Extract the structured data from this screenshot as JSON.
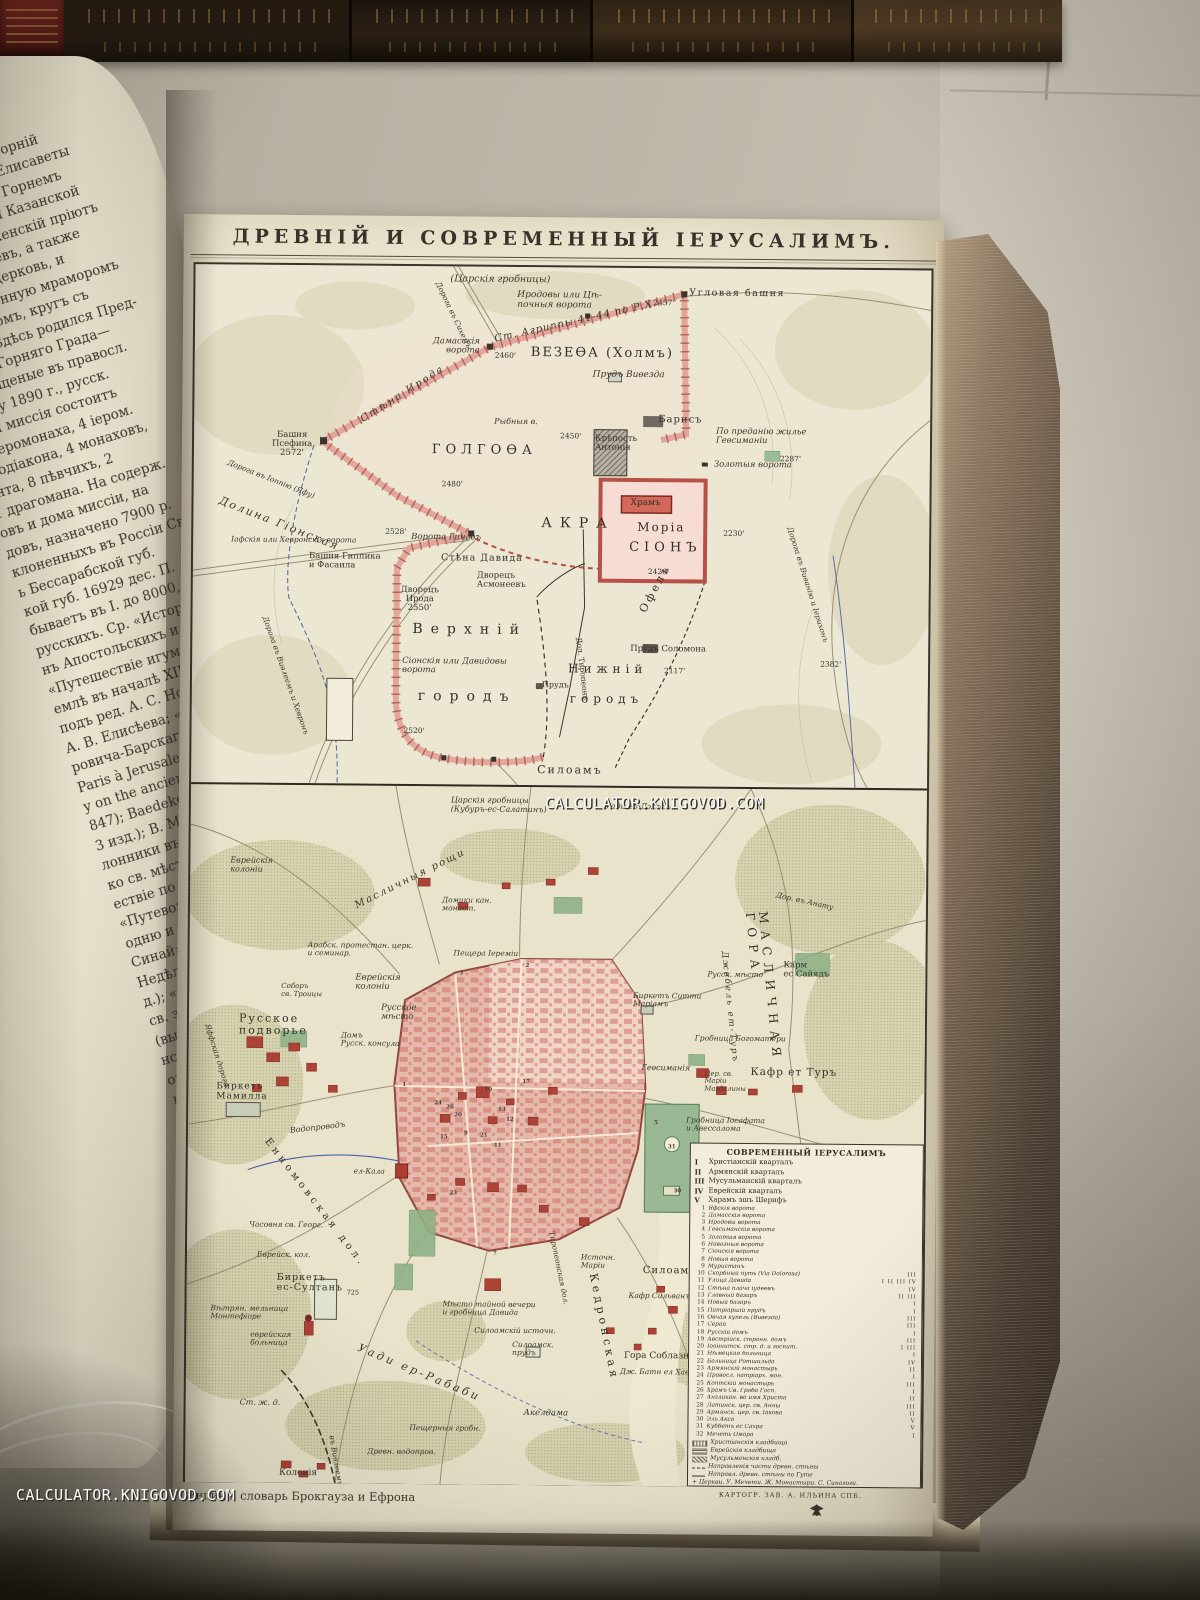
{
  "watermark": {
    "text": "CALCULATOR.KNIGOVOD.COM"
  },
  "page": {
    "title": "ДРЕВНІЙ И СОВРЕМЕННЫЙ ІЕРУСАЛИМЪ.",
    "caption_left": "Энцикл. словарь Брокгауза и Ефрона",
    "caption_right": "КАРТОГР. ЗАВ. А. ИЛЬИНА СПБ."
  },
  "left_page": {
    "lines": [
      "Горняя» или «Горній",
      "али Захарія и Елисаветы",
      "Предтечи. Въ Горнемъ",
      "храмъ во имя Казанской",
      "астырскій женскій пріютъ",
      "богомольцевъ, а также",
      "астырь и церковь, и",
      "ъ выложенную мраморомъ",
      "престоломъ, кругъ съ",
      "ъ яз.: «Здѣсь родился Пред-",
      "ители Горняго Града—",
      "ю крещеные въ правосл.",
      "штату 1890 г., русск.",
      "зная миссія состоитъ",
      "п. іеромонаха, 4 іером.",
      "еродіакона, 4 монаховъ,",
      "ента, 8 пѣвчихъ, 2",
      "1 драгомана. На содерж.",
      "овъ и дома миссіи, на",
      "довъ, назначено 7900 р.",
      "клоненныхъ въ Россіи Св.",
      "ь Бессарабской губ.",
      "кой губ. 16929 дес. П.",
      "бываетъ въ І. до 8000, изъ",
      "русскихъ. Ср. «Исторія",
      "нъ Апостольскихъ и до",
      "«Путешествіе игумена",
      "емлѣ въ началѣ XII в.»",
      "подъ ред. А. С. Норова;",
      "А. В. Елисѣева; «Стран-",
      "ровича-Барскаго; Chateau-",
      "Paris à Jerusalem» (1811);",
      "y on the ancient topo-",
      "847); Baedeker, «Palesti-",
      "3 изд.); В. Мансуровъ,",
      "лонники въ Палестинѣ»",
      "ко св. мѣстамъ въ 18",
      "ествіе по св. землѣ въ",
      "«Путеводитель въ св.",
      "одню и прочимъ св.",
      "Синай», паломника-свя-",
      "Недѣля въ Палестинѣ»,",
      "д.); «Спутникъ правосл.",
      "св. землю», протоіерея",
      "(вып. 2-й); «Воспомина-",
      "нстантинополь, Каиръ и",
      "оптева; «Путешествіе",
      "ину», Е. Картавцевъ",
      "омъ мѣстѣ близъ храм.",
      ", архим. Антонина",
      "земля и Библія» (вып.",
      "св. землѣ», В. Н. Хитр.",
      "четы Имп. правосл. пал.",
      "94). О патріаршей библ.",
      "Керамевсъ.",
      "внѣйшія дошедшія до",
      "аключаются въ письм.",
      "ыхъ въ Эль-Амарнѣ, въ",
      "одержащихъ въ себѣ, м.",
      "царя Урсалимму въ",
      "ІІІ (XIV—XV в. до Р. Х.",
      "ѣсь какъ резиденція",
      "властью Египта. Въ Б.",
      "нается, подъ именемъ",
      "тія (XIV, 18), салимск.",
      "царемъ салимскимъ",
      "встрѣчается въ кн.",
      "по главѣ царей хана.",
      "противъ Іисуса Навина"
    ]
  },
  "upper_map": {
    "labels": [
      {
        "t": "(Царскія гробницы)",
        "x": 255,
        "y": 8,
        "s": 9.5,
        "it": 1
      },
      {
        "t": "Иродовы или Цѣ-\nпочныя ворота",
        "x": 322,
        "y": 24,
        "s": 9,
        "it": 1
      },
      {
        "t": "Угловая башня",
        "x": 494,
        "y": 20,
        "s": 9.5,
        "sp": 1.5
      },
      {
        "t": "2457'",
        "x": 458,
        "y": 31,
        "s": 7.5
      },
      {
        "t": "Ст. Агриппы 41-44 по Р.Х.",
        "x": 300,
        "y": 68,
        "s": 10,
        "it": 1,
        "rot": -13,
        "sp": 1
      },
      {
        "t": "ВЕЗЕѲА (Холмъ)",
        "x": 336,
        "y": 79,
        "s": 13,
        "sp": 2
      },
      {
        "t": "Прудъ Виѳезда",
        "x": 398,
        "y": 103,
        "s": 9,
        "it": 1
      },
      {
        "t": "Дамасскія\nворота",
        "x": 238,
        "y": 71,
        "s": 8.5,
        "it": 1,
        "ta": "right"
      },
      {
        "t": "2460'",
        "x": 300,
        "y": 85,
        "s": 7.5
      },
      {
        "t": "Дорога въ Сихемъ",
        "x": 242,
        "y": 12,
        "s": 7.5,
        "it": 1,
        "rot": 64
      },
      {
        "t": "Башня\nПсефина\n2572'",
        "x": 78,
        "y": 166,
        "s": 8.5,
        "ta": "center"
      },
      {
        "t": "Стѣна Ирода",
        "x": 168,
        "y": 150,
        "s": 10,
        "it": 1,
        "rot": -33,
        "sp": 2
      },
      {
        "t": "ГОЛГОѲА",
        "x": 238,
        "y": 177,
        "s": 13,
        "sp": 5
      },
      {
        "t": "2480'",
        "x": 248,
        "y": 214,
        "s": 7.5
      },
      {
        "t": "Рыбныя в.",
        "x": 300,
        "y": 151,
        "s": 8,
        "it": 1
      },
      {
        "t": "2450'",
        "x": 366,
        "y": 165,
        "s": 7.5
      },
      {
        "t": "Крѣпость\nАнтонія",
        "x": 401,
        "y": 167,
        "s": 8.5
      },
      {
        "t": "Барисъ",
        "x": 464,
        "y": 147,
        "s": 10,
        "sp": 1
      },
      {
        "t": "По преданію жилье\nГеѳсиманіи",
        "x": 522,
        "y": 159,
        "s": 8.5,
        "it": 1
      },
      {
        "t": "2287'",
        "x": 586,
        "y": 186,
        "s": 7.5
      },
      {
        "t": "Золотыя ворота",
        "x": 520,
        "y": 192,
        "s": 8.5,
        "it": 1
      },
      {
        "t": "Храмъ",
        "x": 437,
        "y": 231,
        "s": 9
      },
      {
        "t": "Моріа",
        "x": 444,
        "y": 253,
        "s": 12,
        "sp": 2
      },
      {
        "t": "СІОНЪ",
        "x": 436,
        "y": 273,
        "s": 13,
        "sp": 5
      },
      {
        "t": "2420'",
        "x": 455,
        "y": 300,
        "s": 7.5
      },
      {
        "t": "АКРА",
        "x": 348,
        "y": 249,
        "s": 14,
        "sp": 8
      },
      {
        "t": "2230'",
        "x": 530,
        "y": 261,
        "s": 7.5
      },
      {
        "t": "Дорога въ Виѳанію и Іерихонъ",
        "x": 596,
        "y": 254,
        "s": 7.5,
        "it": 1,
        "rot": 72
      },
      {
        "t": "Дорога въ Іоппію (Яфу)",
        "x": 34,
        "y": 194,
        "s": 7.5,
        "it": 1,
        "rot": 21
      },
      {
        "t": "Долина Гіонская",
        "x": 26,
        "y": 230,
        "s": 11,
        "it": 1,
        "rot": 21,
        "sp": 2
      },
      {
        "t": "Іафскія или Хевронскія ворота",
        "x": 38,
        "y": 271,
        "s": 7.5,
        "it": 1
      },
      {
        "t": "2528'",
        "x": 192,
        "y": 262,
        "s": 7.5
      },
      {
        "t": "Ворота Гинаѳъ",
        "x": 218,
        "y": 267,
        "s": 8.5,
        "it": 1
      },
      {
        "t": "Башня Гиппика\nи Фасаила",
        "x": 116,
        "y": 287,
        "s": 8.5
      },
      {
        "t": "Стѣна Давида",
        "x": 248,
        "y": 287,
        "s": 9.5,
        "sp": 1
      },
      {
        "t": "Дворецъ\nИрода\n2550'",
        "x": 208,
        "y": 320,
        "s": 8.5,
        "ta": "center"
      },
      {
        "t": "Дворецъ\nАсмонеевъ",
        "x": 284,
        "y": 305,
        "s": 8.5
      },
      {
        "t": "Верхній",
        "x": 220,
        "y": 356,
        "s": 14,
        "sp": 8
      },
      {
        "t": "Сіонскія или Давидовы\nворота",
        "x": 210,
        "y": 391,
        "s": 8.5,
        "it": 1
      },
      {
        "t": "городъ",
        "x": 226,
        "y": 423,
        "s": 14,
        "sp": 8
      },
      {
        "t": "2520'",
        "x": 212,
        "y": 461,
        "s": 7.5
      },
      {
        "t": "Нижній",
        "x": 376,
        "y": 395,
        "s": 12,
        "sp": 5
      },
      {
        "t": "городъ",
        "x": 378,
        "y": 425,
        "s": 12,
        "sp": 5
      },
      {
        "t": "Прудъ",
        "x": 350,
        "y": 414,
        "s": 8
      },
      {
        "t": "Прудъ Соломона",
        "x": 438,
        "y": 377,
        "s": 8.5
      },
      {
        "t": "2117'",
        "x": 472,
        "y": 399,
        "s": 7.5
      },
      {
        "t": "Дол. Тиропеонъ",
        "x": 386,
        "y": 366,
        "s": 7.5,
        "rot": 83
      },
      {
        "t": "Офелъ",
        "x": 450,
        "y": 338,
        "s": 11,
        "sp": 3,
        "rot": -62
      },
      {
        "t": "Дорога въ Виѳлеемъ и Хевронъ",
        "x": 72,
        "y": 348,
        "s": 7.5,
        "it": 1,
        "rot": 70
      },
      {
        "t": "2382'",
        "x": 628,
        "y": 391,
        "s": 7.5
      },
      {
        "t": "Силоамъ",
        "x": 346,
        "y": 497,
        "s": 11,
        "sp": 2
      }
    ]
  },
  "lower_map": {
    "labels": [
      {
        "t": "Царскія гробницы\n(Кубуръ-ес-Салатинъ)",
        "x": 260,
        "y": 10,
        "s": 8,
        "it": 1
      },
      {
        "t": "Уади ед-Джосъ",
        "x": 414,
        "y": 15,
        "s": 8,
        "it": 1
      },
      {
        "t": "Масличныя рощи",
        "x": 166,
        "y": 116,
        "s": 10,
        "it": 1,
        "rot": -27,
        "sp": 2
      },
      {
        "t": "Еврейскія\nколоніи",
        "x": 40,
        "y": 72,
        "s": 8,
        "it": 1
      },
      {
        "t": "Домики кан.\nмонаст.",
        "x": 252,
        "y": 110,
        "s": 7.5,
        "it": 1
      },
      {
        "t": "Арабск. протестан. церк.\nи семинар.",
        "x": 118,
        "y": 156,
        "s": 7.5,
        "it": 1
      },
      {
        "t": "Пещера Іереміи",
        "x": 264,
        "y": 163,
        "s": 7.5,
        "it": 1
      },
      {
        "t": "Еврейскія\nколоніи",
        "x": 166,
        "y": 188,
        "s": 8.5,
        "it": 1
      },
      {
        "t": "Русское\nмѣсто",
        "x": 192,
        "y": 218,
        "s": 8.5,
        "it": 1
      },
      {
        "t": "Русское\nподворье",
        "x": 50,
        "y": 228,
        "s": 11,
        "sp": 2
      },
      {
        "t": "Соборъ\nсв. Троицы",
        "x": 92,
        "y": 198,
        "s": 7,
        "it": 1
      },
      {
        "t": "Домъ\nРусск. консула",
        "x": 152,
        "y": 246,
        "s": 7.5,
        "it": 1
      },
      {
        "t": "Яффская дорога",
        "x": 18,
        "y": 236,
        "s": 7.5,
        "it": 1,
        "rot": 72
      },
      {
        "t": "Биркетъ Ситти\nМаріамъ",
        "x": 444,
        "y": 204,
        "s": 7.5,
        "it": 1
      },
      {
        "t": "Геѳсиманія",
        "x": 453,
        "y": 276,
        "s": 8,
        "it": 1
      },
      {
        "t": "Гробница Богоматери",
        "x": 506,
        "y": 246,
        "s": 7.5,
        "it": 1
      },
      {
        "t": "Русск. мѣсто",
        "x": 518,
        "y": 182,
        "s": 7.5,
        "it": 1
      },
      {
        "t": "Карм\nес Сайядъ",
        "x": 594,
        "y": 172,
        "s": 8.5
      },
      {
        "t": "МАСЛИЧНАЯ ГОРА",
        "x": 566,
        "y": 110,
        "s": 12,
        "sp": 7,
        "rot": 84
      },
      {
        "t": "Джебель ет-Туръ",
        "x": 534,
        "y": 158,
        "s": 8.5,
        "it": 1,
        "rot": 84,
        "sp": 2
      },
      {
        "t": "Кафр ет Туръ",
        "x": 562,
        "y": 278,
        "s": 10.5,
        "sp": 1
      },
      {
        "t": "Цер. св.\nМаріи\nМагдалины",
        "x": 516,
        "y": 282,
        "s": 6.8,
        "it": 1
      },
      {
        "t": "Дор. въ Анату",
        "x": 586,
        "y": 102,
        "s": 7.5,
        "it": 1,
        "rot": 12
      },
      {
        "t": "Биркетъ\nМамилла",
        "x": 28,
        "y": 298,
        "s": 9,
        "sp": 1
      },
      {
        "t": "Водопроводъ",
        "x": 102,
        "y": 342,
        "s": 8,
        "it": 1,
        "rot": -7
      },
      {
        "t": "Енномовская дол.",
        "x": 78,
        "y": 350,
        "s": 10,
        "sp": 4,
        "rot": 52
      },
      {
        "t": "ел-Кала",
        "x": 166,
        "y": 382,
        "s": 7.5,
        "it": 1
      },
      {
        "t": "Часовня св. Георг.",
        "x": 62,
        "y": 436,
        "s": 7.5,
        "it": 1
      },
      {
        "t": "Еврейск. кол.",
        "x": 70,
        "y": 466,
        "s": 7.5,
        "it": 1
      },
      {
        "t": "Биркетъ\nес-Султанъ",
        "x": 90,
        "y": 488,
        "s": 9.5,
        "sp": 1
      },
      {
        "t": "725",
        "x": 160,
        "y": 504,
        "s": 6.5
      },
      {
        "t": "Вѣтрян. мельница\nМонтефіоре",
        "x": 24,
        "y": 520,
        "s": 7.5,
        "it": 1
      },
      {
        "t": "еврейская\nбольница",
        "x": 64,
        "y": 546,
        "s": 7.5,
        "it": 1
      },
      {
        "t": "Ст. ж. д.",
        "x": 54,
        "y": 614,
        "s": 8,
        "it": 1
      },
      {
        "t": "Колонія",
        "x": 94,
        "y": 684,
        "s": 9
      },
      {
        "t": "Уади ер-Рабаби",
        "x": 172,
        "y": 556,
        "s": 11,
        "it": 1,
        "sp": 3,
        "rot": 22
      },
      {
        "t": "Пещерныя гробн.",
        "x": 224,
        "y": 638,
        "s": 7.5,
        "it": 1
      },
      {
        "t": "Акелдама",
        "x": 338,
        "y": 622,
        "s": 8.5,
        "it": 1
      },
      {
        "t": "Древн. водопров.",
        "x": 182,
        "y": 662,
        "s": 7.5,
        "it": 1
      },
      {
        "t": "Мѣсто тайной вечери\nи гробница Давида",
        "x": 256,
        "y": 514,
        "s": 7.5,
        "it": 1
      },
      {
        "t": "Силоамскій источн.",
        "x": 288,
        "y": 540,
        "s": 7.5,
        "it": 1
      },
      {
        "t": "Силоамск.\nпрудъ",
        "x": 326,
        "y": 554,
        "s": 7.5,
        "it": 1
      },
      {
        "t": "Тиропеонская дол.",
        "x": 364,
        "y": 440,
        "s": 7.5,
        "it": 1,
        "rot": 78
      },
      {
        "t": "Источн.\nМаріи",
        "x": 394,
        "y": 466,
        "s": 7.5,
        "it": 1
      },
      {
        "t": "Силоамъ",
        "x": 456,
        "y": 478,
        "s": 10,
        "sp": 1
      },
      {
        "t": "Кафр Сильванъ",
        "x": 442,
        "y": 504,
        "s": 7.5,
        "it": 1
      },
      {
        "t": "Гора Соблазна",
        "x": 438,
        "y": 564,
        "s": 9
      },
      {
        "t": "Дж. Батн ел Хава",
        "x": 434,
        "y": 580,
        "s": 7.5,
        "it": 1
      },
      {
        "t": "Кедронская",
        "x": 406,
        "y": 480,
        "s": 11,
        "sp": 4,
        "rot": 78
      },
      {
        "t": "въ Виѳлеемъ",
        "x": 146,
        "y": 646,
        "s": 7.5,
        "it": 1,
        "rot": 80
      },
      {
        "t": "Гробница Іосафата\nи Авессалома",
        "x": 498,
        "y": 328,
        "s": 7.5,
        "it": 1
      }
    ],
    "city_numbers": [
      {
        "n": "1",
        "x": 214,
        "y": 296
      },
      {
        "n": "2",
        "x": 336,
        "y": 176
      },
      {
        "n": "3",
        "x": 270,
        "y": 184
      },
      {
        "n": "5",
        "x": 466,
        "y": 332
      },
      {
        "n": "7",
        "x": 306,
        "y": 464
      },
      {
        "n": "9",
        "x": 276,
        "y": 344
      },
      {
        "n": "10",
        "x": 296,
        "y": 300
      },
      {
        "n": "11",
        "x": 306,
        "y": 356
      },
      {
        "n": "12",
        "x": 318,
        "y": 330
      },
      {
        "n": "13",
        "x": 310,
        "y": 320
      },
      {
        "n": "15",
        "x": 252,
        "y": 348
      },
      {
        "n": "17",
        "x": 334,
        "y": 292
      },
      {
        "n": "20",
        "x": 266,
        "y": 326
      },
      {
        "n": "21",
        "x": 292,
        "y": 346
      },
      {
        "n": "23",
        "x": 262,
        "y": 404
      },
      {
        "n": "24",
        "x": 246,
        "y": 314
      },
      {
        "n": "26",
        "x": 258,
        "y": 318
      },
      {
        "n": "30",
        "x": 486,
        "y": 400
      },
      {
        "n": "31",
        "x": 480,
        "y": 356
      }
    ],
    "legend": {
      "title": "СОВРЕМЕННЫЙ ІЕРУСАЛИМЪ",
      "quarters": [
        [
          "I",
          "Христіанскій кварталъ"
        ],
        [
          "II",
          "Армянскій кварталъ"
        ],
        [
          "III",
          "Мусульманскій кварталъ"
        ],
        [
          "IV",
          "Еврейскій кварталъ"
        ],
        [
          "V",
          "Харамъ эшъ Шерифъ"
        ]
      ],
      "items": [
        [
          "1",
          "Яфскія ворота",
          ""
        ],
        [
          "2",
          "Дамасскія ворота",
          ""
        ],
        [
          "3",
          "Иродовы ворота",
          ""
        ],
        [
          "4",
          "Геѳсиманскія ворота",
          ""
        ],
        [
          "5",
          "Золотыя ворота",
          ""
        ],
        [
          "6",
          "Навозныя ворота",
          ""
        ],
        [
          "7",
          "Сіонскія ворота",
          ""
        ],
        [
          "8",
          "Новыя ворота",
          ""
        ],
        [
          "9",
          "Муристанъ",
          ""
        ],
        [
          "10",
          "Скорбный путь (Via Dolorosa)",
          "III"
        ],
        [
          "11",
          "Улица Давида",
          "I II III IV"
        ],
        [
          "12",
          "Стѣна плача іудеевъ",
          "IV"
        ],
        [
          "13",
          "Главный базаръ",
          "II III"
        ],
        [
          "14",
          "Новый базаръ",
          "I"
        ],
        [
          "15",
          "Патріаршій прудъ",
          "I"
        ],
        [
          "16",
          "Овчая купель (Виѳезда)",
          "III"
        ],
        [
          "17",
          "Серай",
          "III"
        ],
        [
          "18",
          "Русскій домъ",
          "I"
        ],
        [
          "19",
          "Австрійск. странн. домъ",
          "III"
        ],
        [
          "20",
          "Іоаннитск. стр. д. и госпит.",
          "I III"
        ],
        [
          "21",
          "Нѣмецкая больница",
          "I"
        ],
        [
          "22",
          "Больница Ротшильда",
          "IV"
        ],
        [
          "23",
          "Армянскій монастырь",
          "II"
        ],
        [
          "24",
          "Правосл. патріарх. мон.",
          "I"
        ],
        [
          "25",
          "Коптскій монастырь",
          "III"
        ],
        [
          "26",
          "Храмъ Св. Гроба Госп.",
          "I"
        ],
        [
          "27",
          "Англикан. во имя Христа",
          "II"
        ],
        [
          "28",
          "Латинск. цер. св. Анны",
          "III"
        ],
        [
          "29",
          "Армянск. цер. св. Іакова",
          "II"
        ],
        [
          "30",
          "Эль Акса",
          "V"
        ],
        [
          "31",
          "Куббетъ ес Сахра",
          "V"
        ],
        [
          "32",
          "Мечеть Омара",
          "I"
        ]
      ],
      "symbols": [
        "Христіанскія кладбища",
        "Еврейскія кладбища",
        "Мусульманскія кладб.",
        "Направленія части древн. стѣны",
        "Направл. древн. стѣны по Гуте",
        "+ Церкви.  У. Мечети.  Ж. Монастыри.  С. Синагоги."
      ]
    }
  }
}
